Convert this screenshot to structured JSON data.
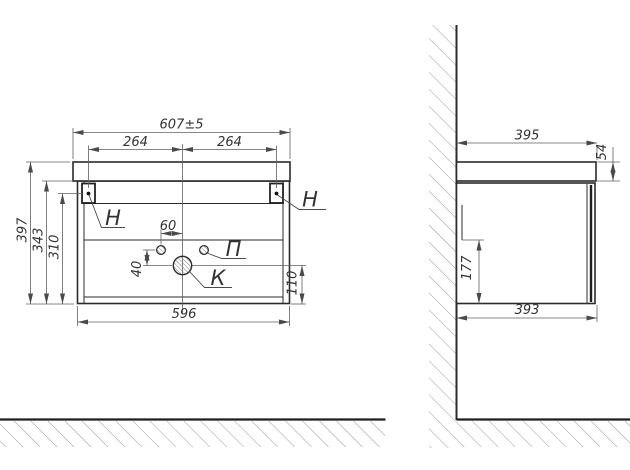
{
  "front_view": {
    "dimensions": {
      "overall_width": "607±5",
      "hanger_spacing_left": "264",
      "hanger_spacing_right": "264",
      "overall_height": "397",
      "body_height": "343",
      "hanger_height": "310",
      "body_width": "596",
      "hole_offset": "60",
      "hole_vertical_gap": "40",
      "drain_center_height": "110"
    },
    "labels": {
      "hanger_left": "Н",
      "hanger_right": "Н",
      "pilot_holes": "П",
      "drain_hole": "К"
    }
  },
  "side_view": {
    "dimensions": {
      "top_depth": "395",
      "top_thickness": "54",
      "back_rail_height": "177",
      "body_depth": "393"
    }
  },
  "colors": {
    "outline": "#2b2b2b",
    "dimension_line": "#5f5f5f",
    "hatch": "#9b9b9b",
    "text": "#333333",
    "background": "#ffffff"
  }
}
